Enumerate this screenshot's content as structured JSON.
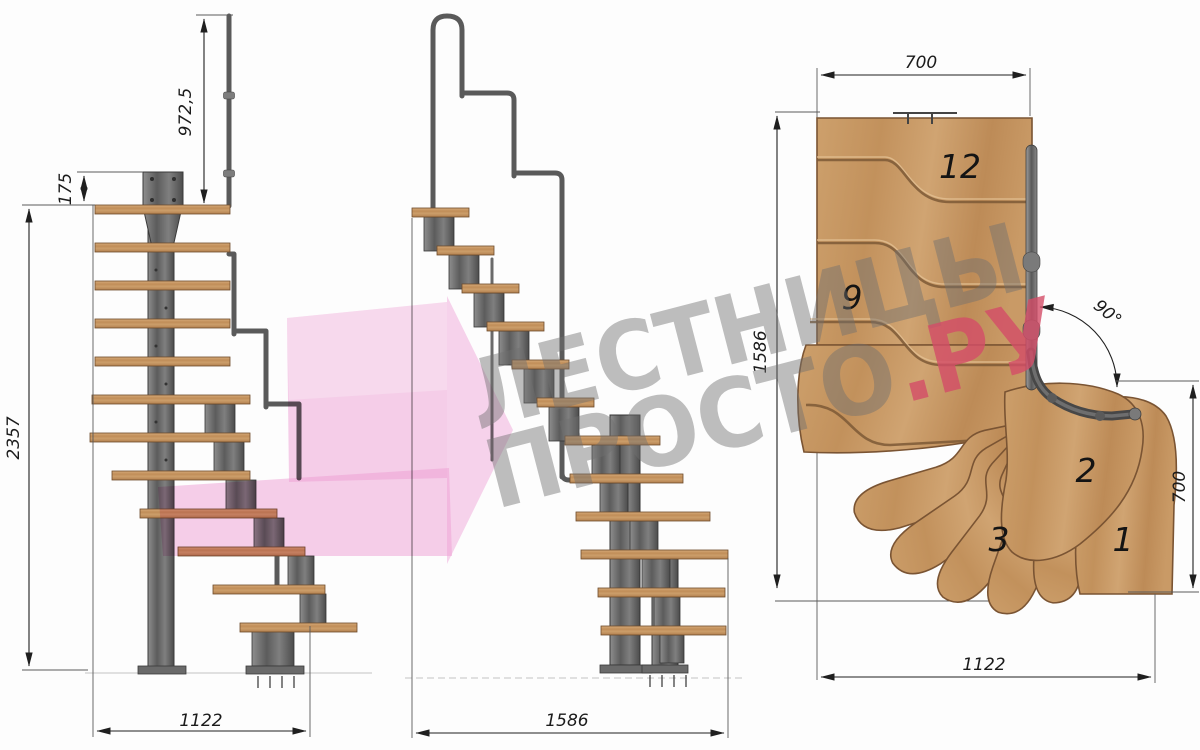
{
  "drawing": {
    "front_view": {
      "dims": {
        "handrail_height": "972,5",
        "plate_height": "175",
        "total_height": "2357",
        "width": "1122"
      }
    },
    "side_view": {
      "dims": {
        "length": "1586"
      }
    },
    "plan_view": {
      "dims": {
        "top_width": "700",
        "side_length": "1586",
        "turn_angle": "90°",
        "right_depth": "700",
        "bottom_width": "1122"
      },
      "steps": {
        "s12": "12",
        "s9": "9",
        "s3": "3",
        "s2": "2",
        "s1": "1"
      }
    }
  },
  "watermark": {
    "line1": "ЛЕСТНИЦЫ",
    "line2": "ПРОСТО",
    "line2_accent": ".РУ",
    "gray": "#707070",
    "red": "#d44d68",
    "pink": "#f0a0d6"
  },
  "colors": {
    "wood": "#c89a68",
    "wood_edge": "#7a5433",
    "metal": "#6f6f6f",
    "metal_dark": "#3c3c3c",
    "dimension": "#1f1f1f",
    "background": "#fdfdfd"
  }
}
